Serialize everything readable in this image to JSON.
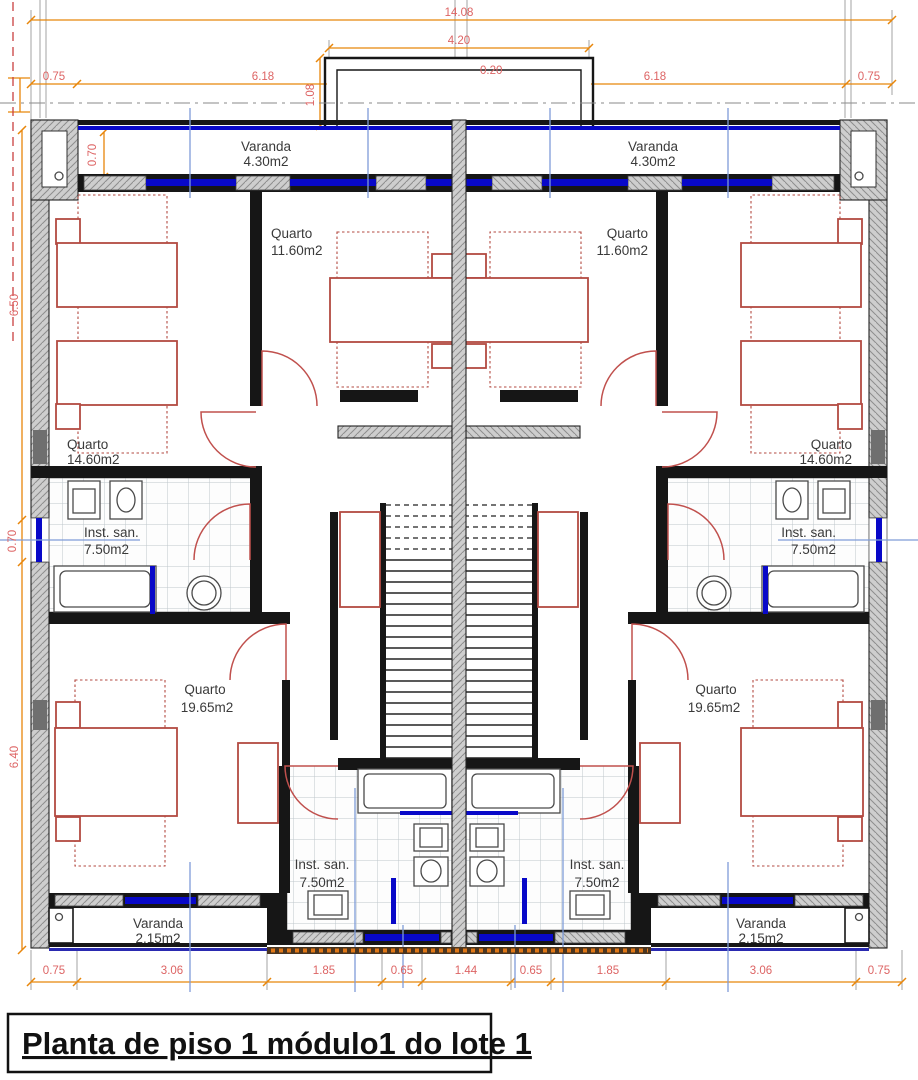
{
  "title_block": {
    "text": "Planta de piso 1 módulo1 do lote 1"
  },
  "rooms": {
    "varanda_top_left": {
      "name": "Varanda",
      "area": "4.30m2"
    },
    "varanda_top_right": {
      "name": "Varanda",
      "area": "4.30m2"
    },
    "quarto_top_left": {
      "name": "Quarto",
      "area": "14.60m2"
    },
    "quarto_top_right": {
      "name": "Quarto",
      "area": "14.60m2"
    },
    "quarto_mid_left": {
      "name": "Quarto",
      "area": "11.60m2"
    },
    "quarto_mid_right": {
      "name": "Quarto",
      "area": "11.60m2"
    },
    "bath_mid_left": {
      "name": "Inst. san.",
      "area": "7.50m2"
    },
    "bath_mid_right": {
      "name": "Inst. san.",
      "area": "7.50m2"
    },
    "quarto_bottom_left": {
      "name": "Quarto",
      "area": "19.65m2"
    },
    "quarto_bottom_right": {
      "name": "Quarto",
      "area": "19.65m2"
    },
    "bath_bottom_left": {
      "name": "Inst. san.",
      "area": "7.50m2"
    },
    "bath_bottom_right": {
      "name": "Inst. san.",
      "area": "7.50m2"
    },
    "varanda_bottom_left": {
      "name": "Varanda",
      "area": "2.15m2"
    },
    "varanda_bottom_right": {
      "name": "Varanda",
      "area": "2.15m2"
    }
  },
  "dimensions": {
    "top_overall": "14.08",
    "top_protrusion": "4.20",
    "top_wall": "0.20",
    "protrusion_depth": "1.08",
    "top_row": {
      "left_eave": "0.75",
      "left_span": "6.18",
      "right_span": "6.18",
      "right_eave": "0.75"
    },
    "left_col": {
      "upper": "6.50",
      "window": "0.70",
      "lower": "6.40"
    },
    "varanda_depth": "0.70",
    "bottom_row": [
      "0.75",
      "3.06",
      "1.85",
      "0.65",
      "1.44",
      "0.65",
      "1.85",
      "3.06",
      "0.75"
    ]
  },
  "colors": {
    "walls": "#161616",
    "wall_hatch": "#cecece",
    "furniture_red": "#b34a42",
    "door_red": "#c0504d",
    "window_blue": "#0808c8",
    "centerline_blue": "#7f9cd8",
    "dimension_orange": "#e8860a",
    "dimension_text": "#dd6464",
    "tile_grid": "#bfc6cc"
  }
}
